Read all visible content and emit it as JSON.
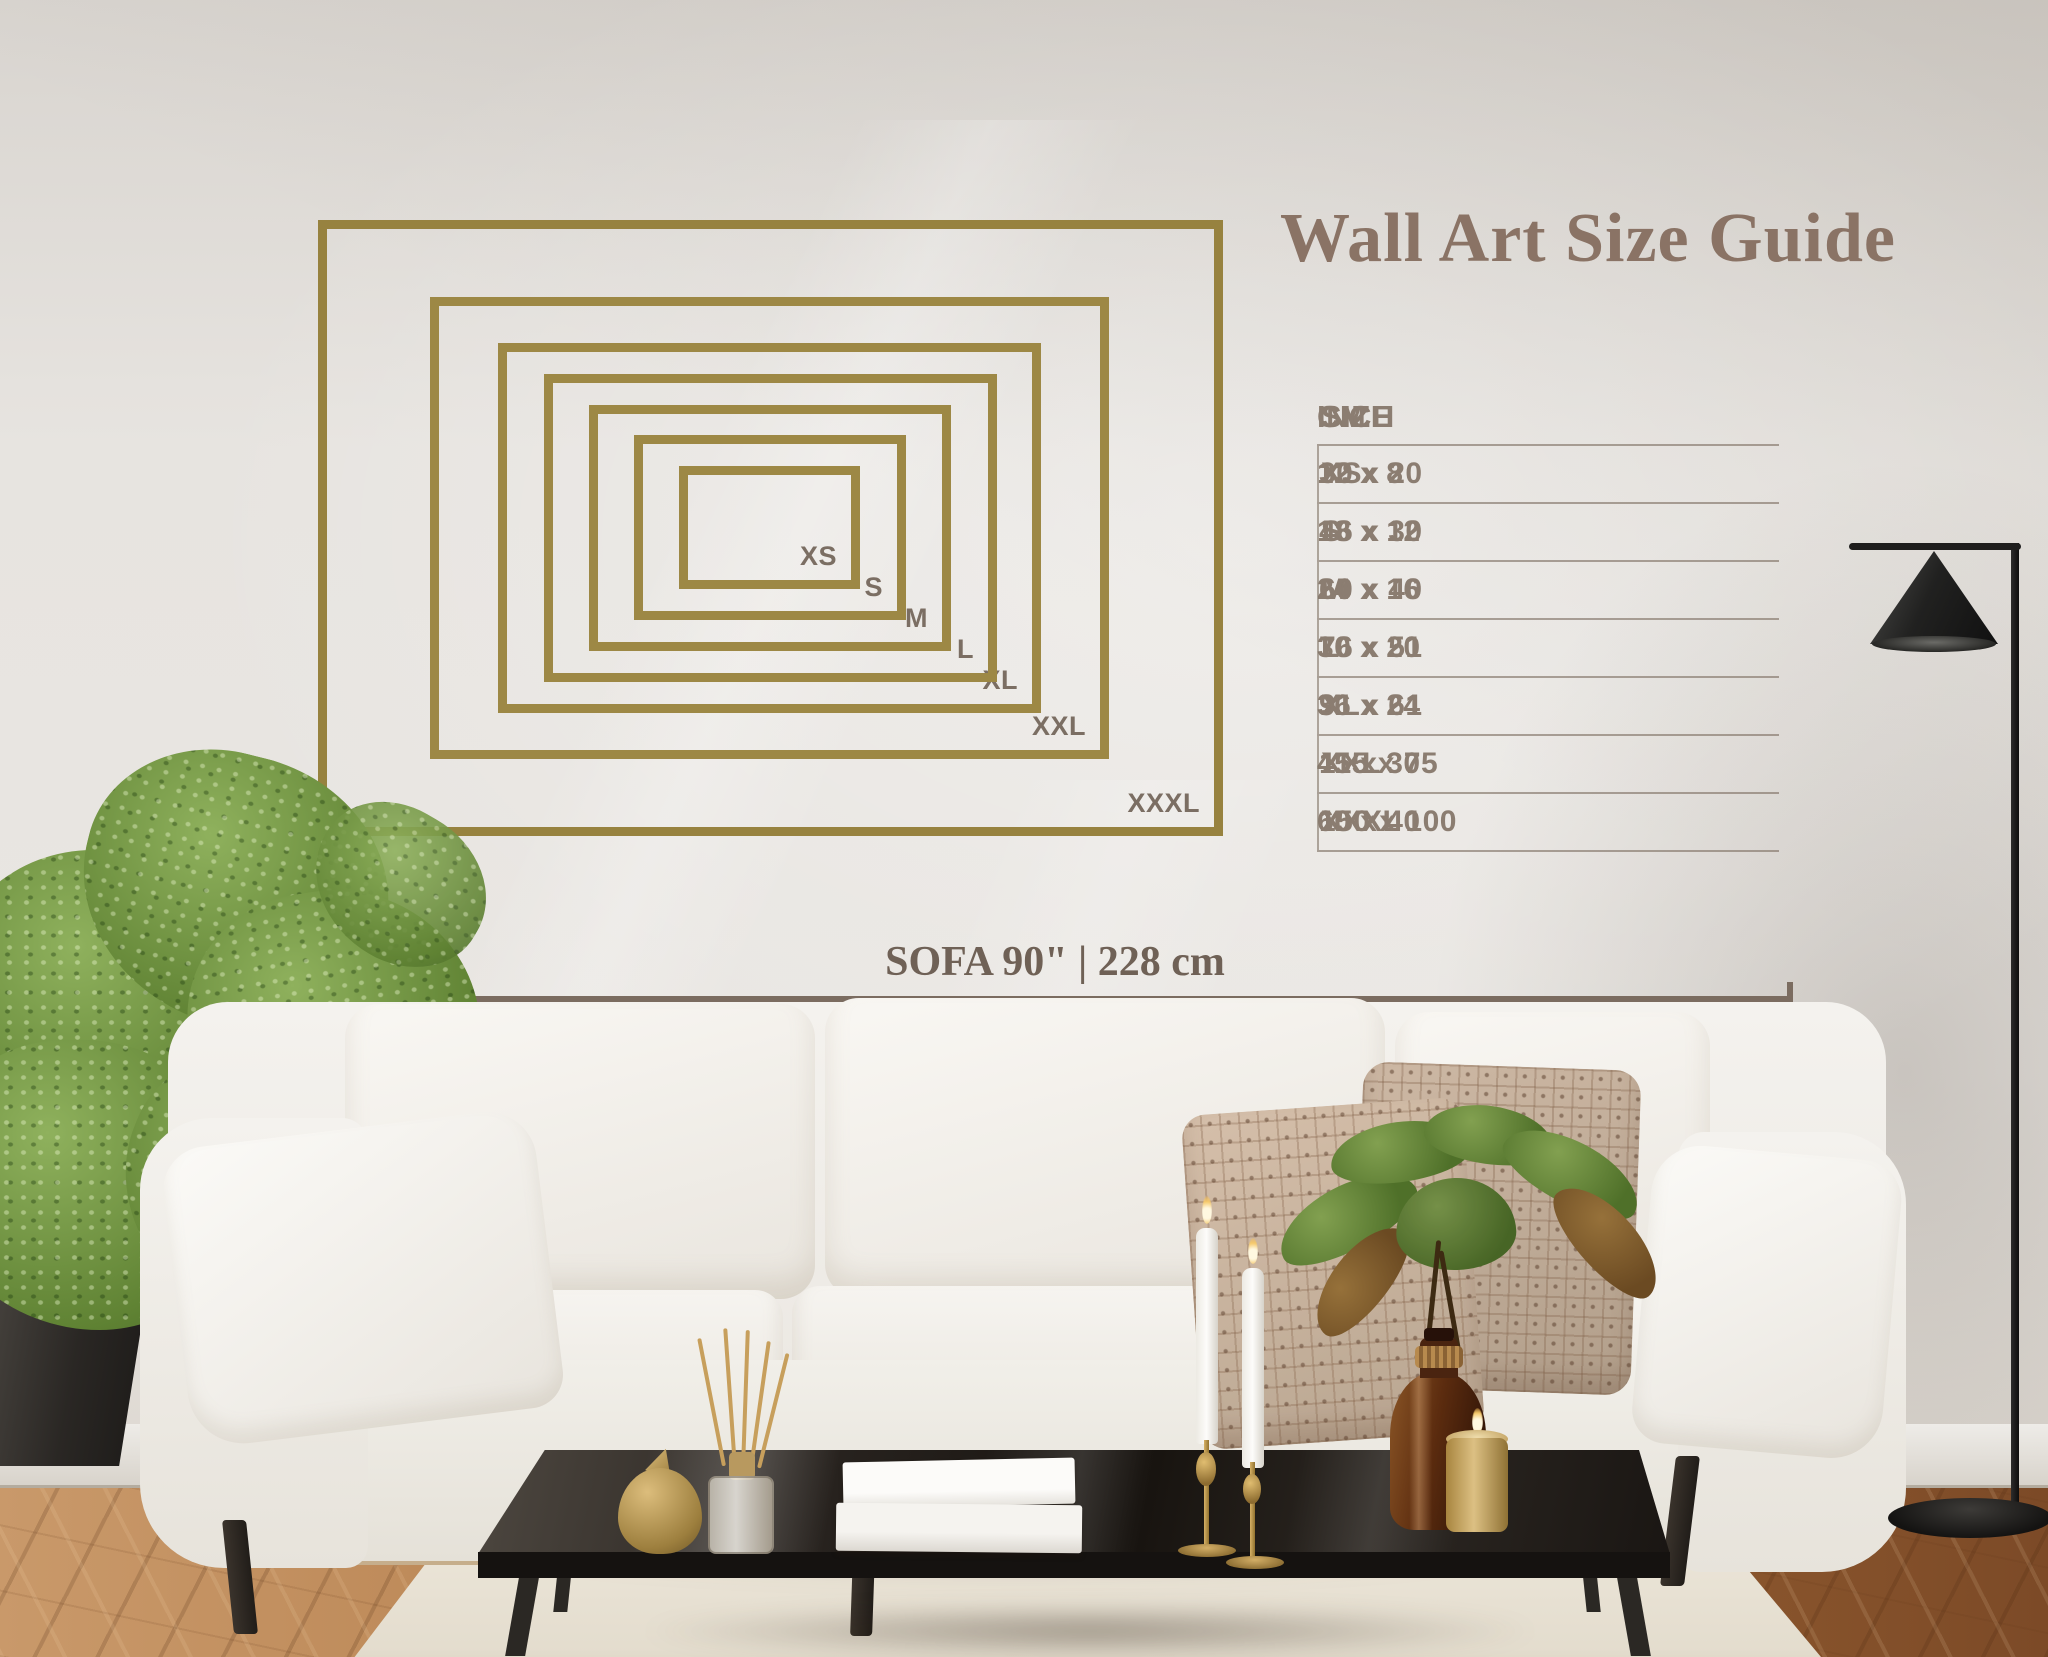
{
  "title": {
    "text": "Wall Art Size Guide"
  },
  "frames": {
    "items": [
      {
        "label": "XXXL"
      },
      {
        "label": "XXL"
      },
      {
        "label": "XL"
      },
      {
        "label": "L"
      },
      {
        "label": "M"
      },
      {
        "label": "S"
      },
      {
        "label": "XS"
      }
    ]
  },
  "table": {
    "headers": {
      "size": "SIZE",
      "inch": "INCH",
      "cm": "CM"
    },
    "rows": [
      {
        "size": "XS",
        "inch": "12 x 8",
        "cm": "30 x 20"
      },
      {
        "size": "S",
        "inch": "18 x 12",
        "cm": "46 x 30"
      },
      {
        "size": "M",
        "inch": "24 x 16",
        "cm": "60 x 40"
      },
      {
        "size": "L",
        "inch": "30 x 20",
        "cm": "76 x 51"
      },
      {
        "size": "XL",
        "inch": "36 x 24",
        "cm": "91 x 61"
      },
      {
        "size": "XXL",
        "inch": "45 x 30",
        "cm": "115 x 75"
      },
      {
        "size": "XXXL",
        "inch": "60 x 40",
        "cm": "150 x 100"
      }
    ]
  },
  "sofa": {
    "label": "SOFA 90\" | 228 cm"
  },
  "colors": {
    "frame_gold": "#9d8845",
    "label_brown": "#7b6e63",
    "title_brown": "#8a7365",
    "table_text": "#8b7d71",
    "measure_line": "#7b6c60",
    "wall": "#e7e4e0",
    "wood_floor": "#a06a3a",
    "rug": "#eae4d8",
    "sofa_fabric": "#f2f0ec",
    "taupe_pillow": "#c3ad9a"
  }
}
